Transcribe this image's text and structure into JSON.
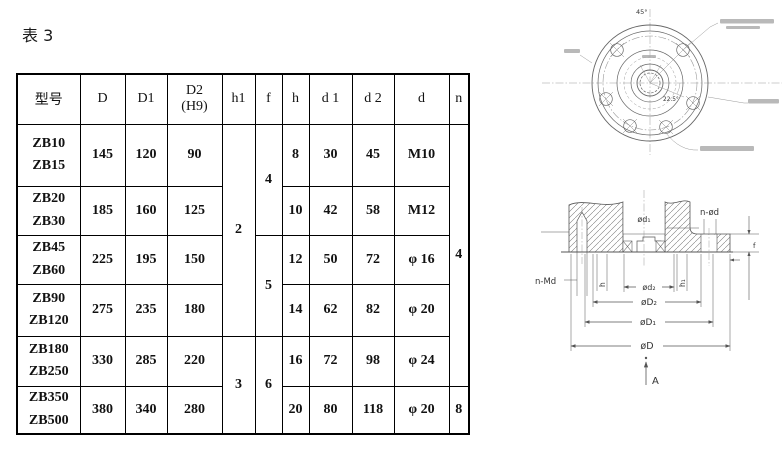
{
  "page": {
    "title": "表 3"
  },
  "table": {
    "headers": {
      "model": "型号",
      "D": "D",
      "D1": "D1",
      "D2": "D2",
      "D2_note": "(H9)",
      "h1": "h1",
      "f": "f",
      "h": "h",
      "d1": "d 1",
      "d2": "d 2",
      "d": "d",
      "n": "n"
    },
    "rows": [
      {
        "models": [
          "ZB10",
          "ZB15"
        ],
        "D": "145",
        "D1": "120",
        "D2": "90",
        "h": "8",
        "d1": "30",
        "d2": "45",
        "d": "M10"
      },
      {
        "models": [
          "ZB20",
          "ZB30"
        ],
        "D": "185",
        "D1": "160",
        "D2": "125",
        "h": "10",
        "d1": "42",
        "d2": "58",
        "d": "M12"
      },
      {
        "models": [
          "ZB45",
          "ZB60"
        ],
        "D": "225",
        "D1": "195",
        "D2": "150",
        "h": "12",
        "d1": "50",
        "d2": "72",
        "d": "φ 16"
      },
      {
        "models": [
          "ZB90",
          "ZB120"
        ],
        "D": "275",
        "D1": "235",
        "D2": "180",
        "h": "14",
        "d1": "62",
        "d2": "82",
        "d": "φ 20"
      },
      {
        "models": [
          "ZB180",
          "ZB250"
        ],
        "D": "330",
        "D1": "285",
        "D2": "220",
        "h": "16",
        "d1": "72",
        "d2": "98",
        "d": "φ 24"
      },
      {
        "models": [
          "ZB350",
          "ZB500"
        ],
        "D": "380",
        "D1": "340",
        "D2": "280",
        "h": "20",
        "d1": "80",
        "d2": "118",
        "d": "φ 20"
      }
    ],
    "merged": {
      "h1_rows1to4": "2",
      "h1_rows5to6": "3",
      "f_rows1to2": "4",
      "f_rows3to4": "5",
      "f_rows5to6": "6",
      "n_rows1to5": "4",
      "n_row6": "8"
    }
  },
  "front_view": {
    "angle_top": "45°",
    "angle_center": "22.5°"
  },
  "section_view": {
    "labels": {
      "d1": "ød₁",
      "n_od": "n-ød",
      "n_md": "n-Md",
      "h": "h",
      "d2": "ød₂",
      "h1": "h₁",
      "D2": "øD₂",
      "D1": "øD₁",
      "D": "øD",
      "f": "f",
      "A": "A"
    }
  }
}
